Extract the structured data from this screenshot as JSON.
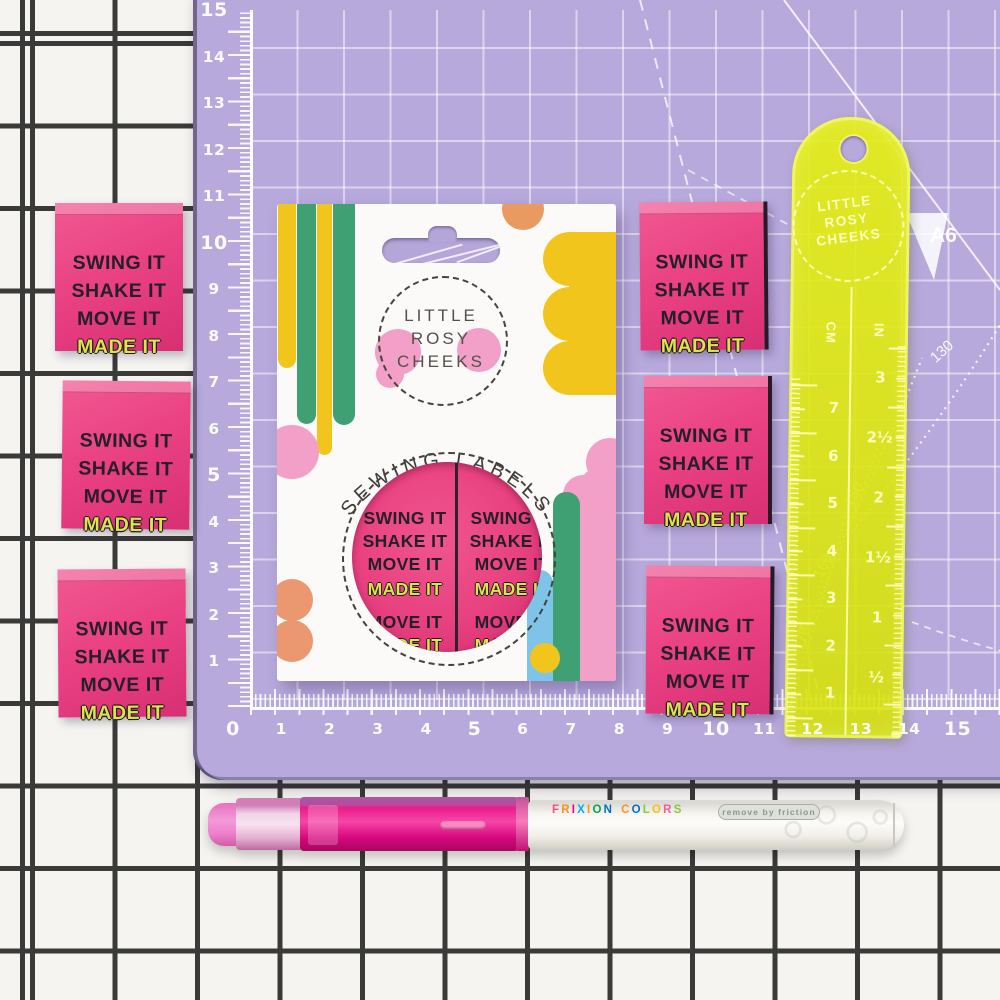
{
  "scene": {
    "description": "Flat-lay product photo: pink woven sewing labels, packaging card, neon ruler and pen on a lavender cutting mat over a white grid background"
  },
  "colors": {
    "mat": "#b7a9db",
    "label_pink": "#ea4283",
    "made_it_yellow": "#dde24e",
    "ruler_yellow": "#dce416",
    "pen_magenta": "#ec1e8e",
    "card_white": "#fbfaf8",
    "bg_grid_line": "#3a3a38"
  },
  "mat": {
    "v_scale": [
      "15",
      "14",
      "13",
      "12",
      "11",
      "10",
      "9",
      "8",
      "7",
      "6",
      "5",
      "4",
      "3",
      "2",
      "1"
    ],
    "h_scale": [
      "0",
      "1",
      "2",
      "3",
      "4",
      "5",
      "6",
      "7",
      "8",
      "9",
      "10",
      "11",
      "12",
      "13",
      "14",
      "15"
    ],
    "a6_label": "A6",
    "curve_labels": [
      "130",
      "150",
      "160",
      "170"
    ]
  },
  "sewing_label": {
    "lines": [
      "SWING IT",
      "SHAKE IT",
      "MOVE IT",
      "MADE IT"
    ]
  },
  "package": {
    "brand_lines": [
      "LITTLE",
      "ROSY",
      "CHEEKS"
    ],
    "product_title": "SEWING LABELS",
    "window_lines": [
      "SWING IT",
      "SHAKE IT",
      "MOVE IT",
      "MADE IT"
    ],
    "window_partial_lines": [
      "MOVE IT",
      "MADE IT"
    ]
  },
  "ruler": {
    "brand_lines": [
      "LITTLE",
      "ROSY",
      "CHEEKS"
    ],
    "cm_label": "CM",
    "in_label": "IN",
    "cm_numbers": [
      "7",
      "6",
      "5",
      "4",
      "3",
      "2",
      "1"
    ],
    "in_numbers": [
      "3",
      "2½",
      "2",
      "1½",
      "1",
      "½"
    ]
  },
  "pen": {
    "brand_letters": [
      [
        "F",
        "#f2527d"
      ],
      [
        "R",
        "#f7941d"
      ],
      [
        "I",
        "#ec008c"
      ],
      [
        "X",
        "#00aeef"
      ],
      [
        "I",
        "#f7941d"
      ],
      [
        "O",
        "#00a651"
      ],
      [
        "N",
        "#0072bc"
      ],
      [
        " ",
        ""
      ],
      [
        "C",
        "#f7941d"
      ],
      [
        "O",
        "#0072bc"
      ],
      [
        "L",
        "#8dc63f"
      ],
      [
        "O",
        "#f9c10e"
      ],
      [
        "R",
        "#f0609e"
      ],
      [
        "S",
        "#8dc63f"
      ]
    ],
    "pill_text": "remove by friction"
  }
}
